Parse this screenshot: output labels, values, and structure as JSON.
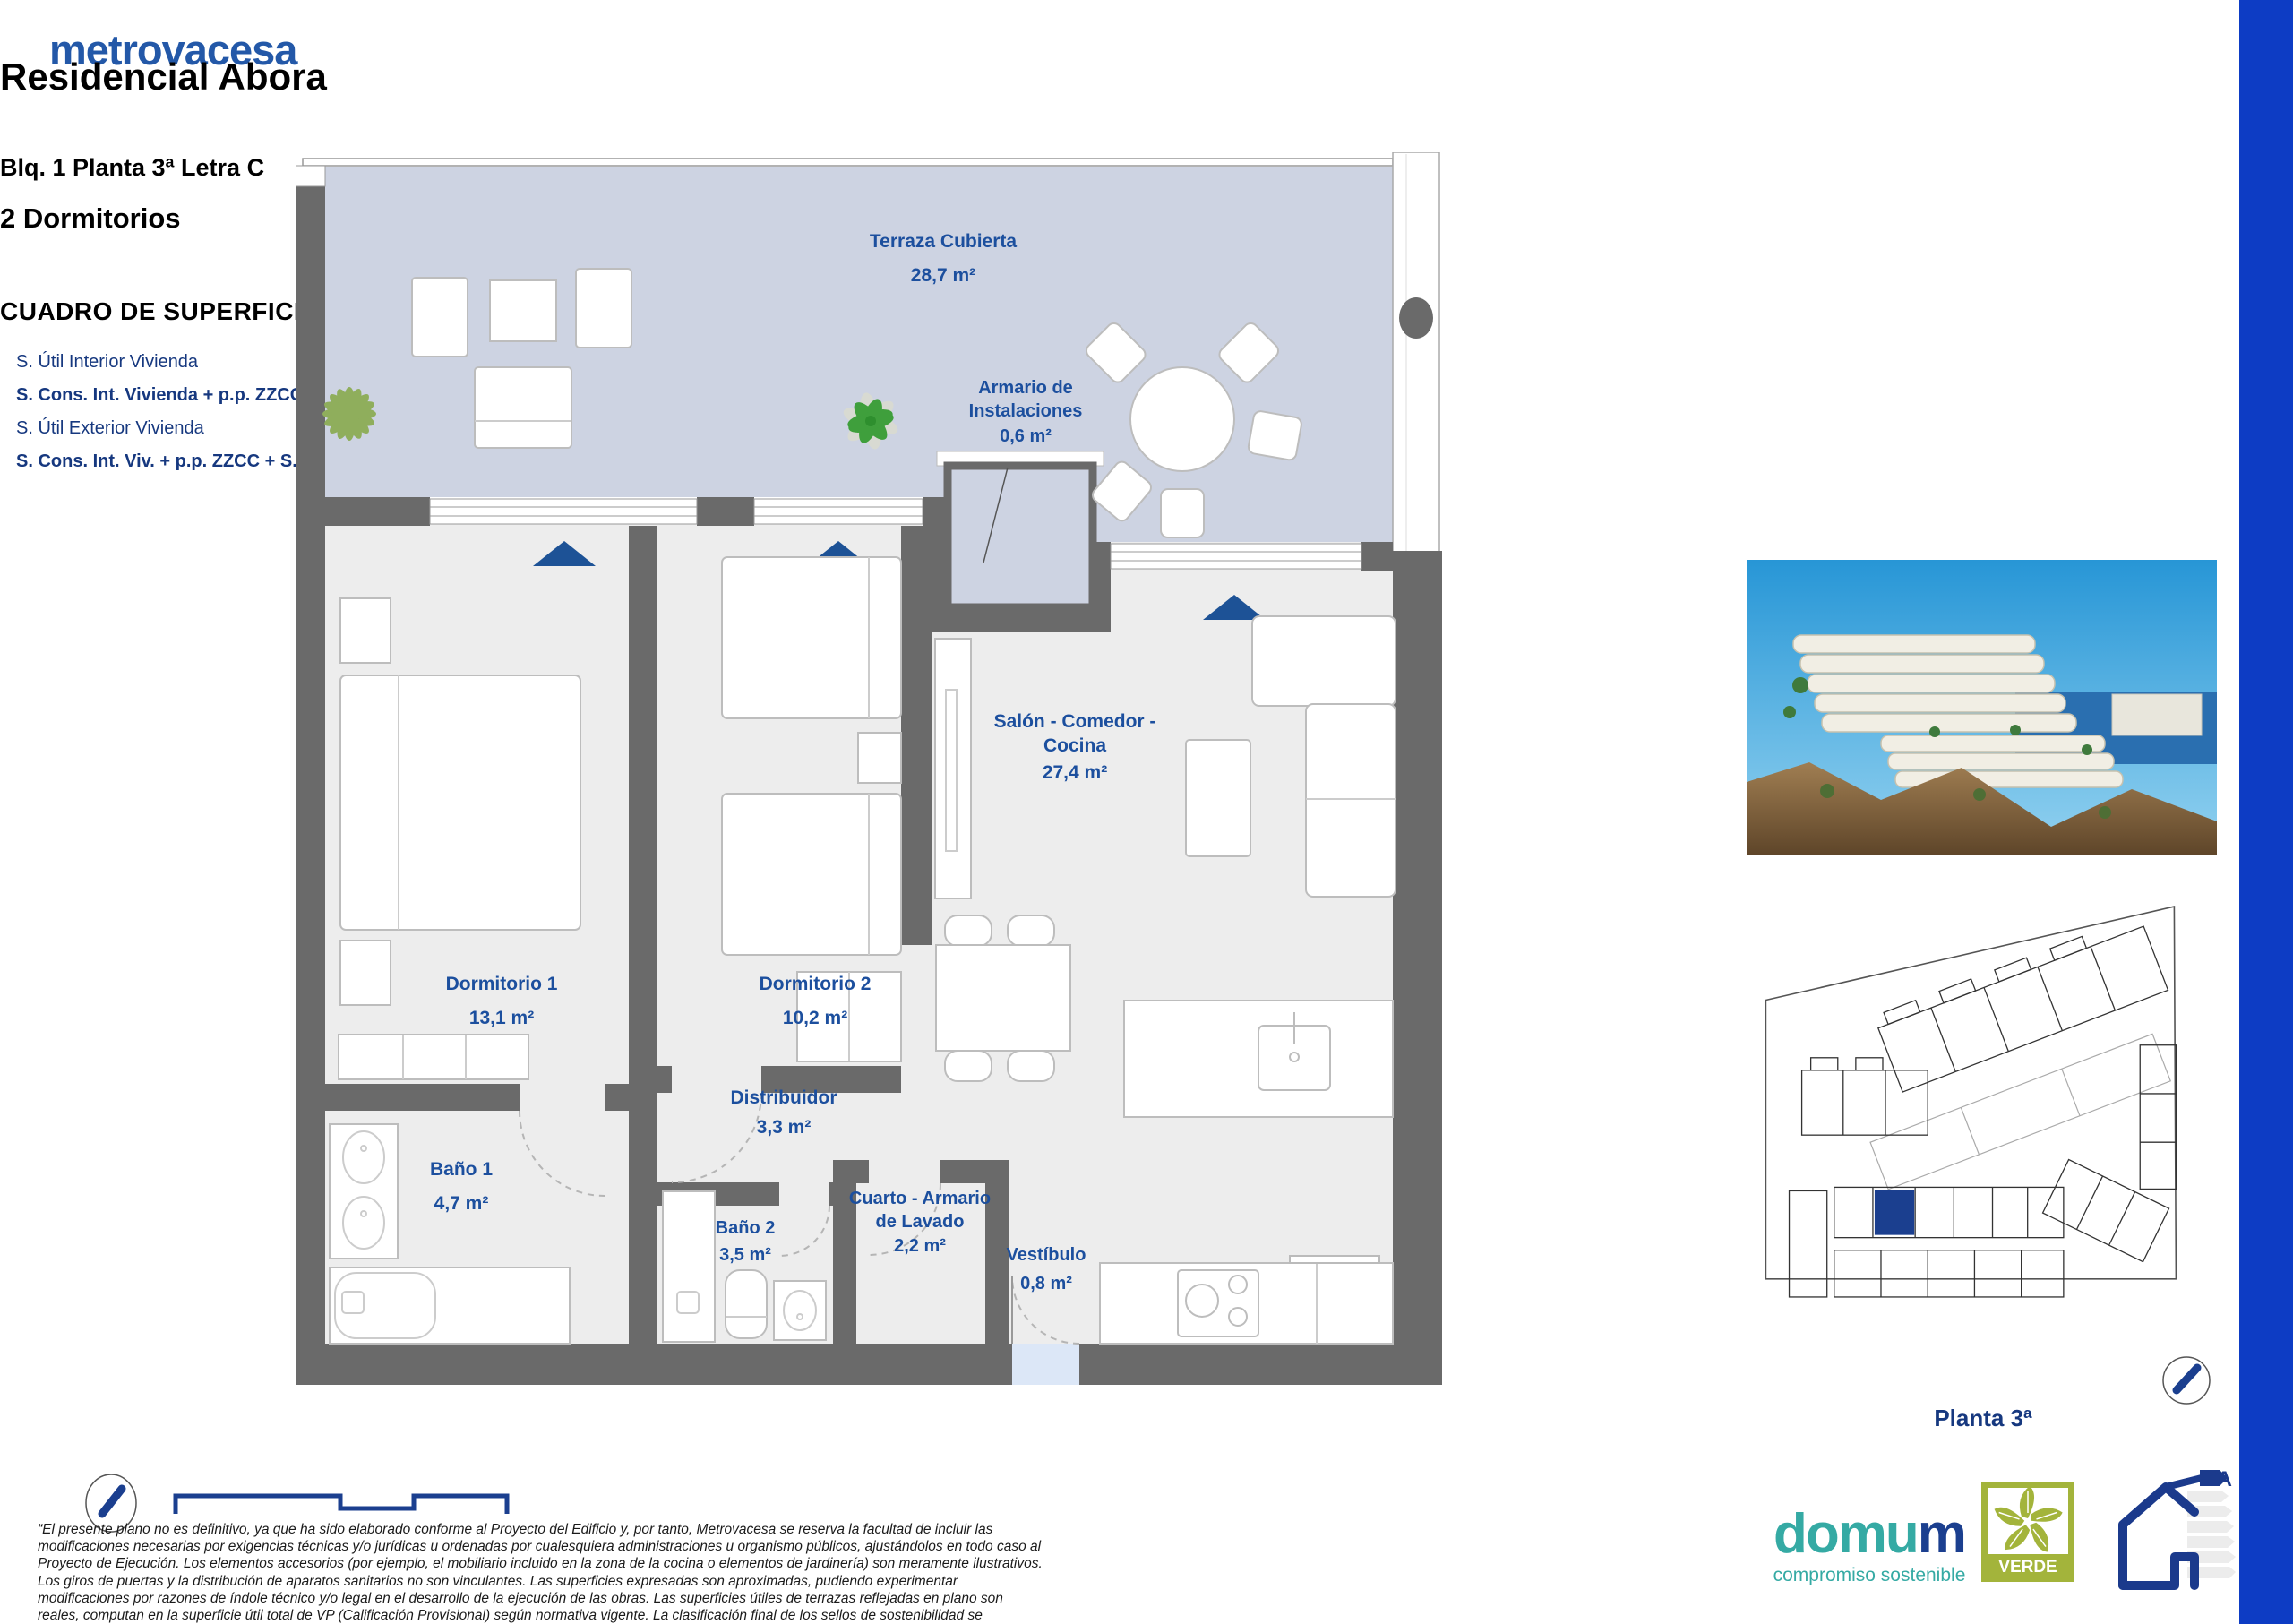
{
  "brand": {
    "logo": "metrovacesa"
  },
  "header": {
    "title": "Residencial Abora",
    "block_line": "Blq. 1 Planta 3ª Letra C",
    "bedrooms": "2 Dormitorios"
  },
  "surfaces": {
    "title": "CUADRO DE SUPERFICIES",
    "rows": [
      {
        "label": "S. Útil Interior Vivienda",
        "value": "65,9 m²"
      },
      {
        "label": "S. Cons. Int. Vivienda + p.p. ZZCC",
        "value": "103,6 m²"
      },
      {
        "label": "S. Útil Exterior Vivienda",
        "value": "28,9 m²"
      },
      {
        "label": "S. Cons. Int. Viv. + p.p. ZZCC + S. Útil Ext. Viv.",
        "value": "132,5 m²"
      }
    ]
  },
  "plan": {
    "rooms": [
      {
        "name": "Terraza Cubierta",
        "area": "28,7 m²"
      },
      {
        "name": "Armario de Instalaciones",
        "area": "0,6 m²"
      },
      {
        "name": "Dormitorio 1",
        "area": "13,1 m²"
      },
      {
        "name": "Dormitorio 2",
        "area": "10,2 m²"
      },
      {
        "name": "Salón - Comedor - Cocina",
        "area": "27,4 m²"
      },
      {
        "name": "Baño 1",
        "area": "4,7 m²"
      },
      {
        "name": "Distribuidor",
        "area": "3,3 m²"
      },
      {
        "name": "Baño 2",
        "area": "3,5 m²"
      },
      {
        "name": "Cuarto - Armario de Lavado",
        "area": "2,2 m²"
      },
      {
        "name": "Vestíbulo",
        "area": "0,8 m²"
      }
    ],
    "site_caption": "Planta 3ª"
  },
  "disclaimer": "“El presente plano no es definitivo, ya que ha sido elaborado conforme al Proyecto del Edificio y, por tanto, Metrovacesa se reserva la facultad de incluir las modificaciones necesarias por exigencias técnicas y/o jurídicas u ordenadas por cualesquiera administraciones u organismo públicos, ajustándolos en todo caso al Proyecto de Ejecución. Los elementos accesorios (por ejemplo, el mobiliario incluido en la zona de la cocina o elementos de jardinería) son meramente ilustrativos. Los giros de puertas y la distribución de aparatos sanitarios no son vinculantes. Las superficies expresadas son aproximadas, pudiendo experimentar modificaciones por razones de índole técnico y/o legal en el desarrollo de la ejecución de las obras. Las superficies útiles de terrazas reflejadas en plano son reales, computan en la superficie útil total de VP (Calificación Provisional) según normativa vigente. La clasificación final de los sellos de sostenibilidad se obtendrán tras el desarrollo del Proyecto de Ejecución.”",
  "footer": {
    "domum": {
      "teal_part": "domu",
      "navy_part": "m",
      "tagline": "compromiso sostenible"
    },
    "verde_label": "VERDE",
    "energy_class": "A"
  },
  "colors": {
    "brand_blue": "#2358a8",
    "title_navy": "#16387f",
    "label_blue": "#1c4f9e",
    "side_bar_blue": "#0d3cc4",
    "wall_gray": "#6a6a6a",
    "terrace_fill": "#cdd3e2",
    "interior_fill": "#ededed",
    "domum_teal": "#35aaa4",
    "verde_olive": "#a3b43b"
  }
}
